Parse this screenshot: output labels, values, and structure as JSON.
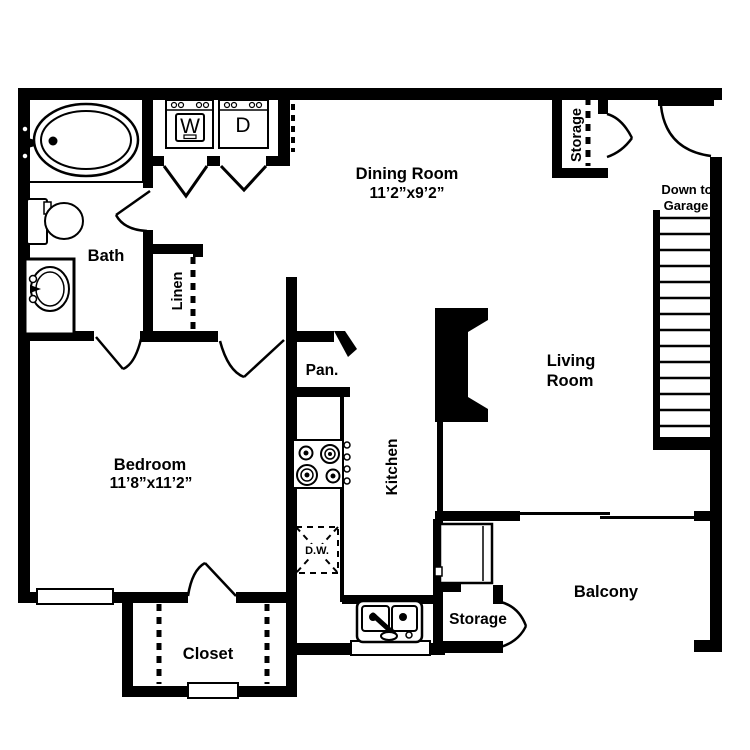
{
  "colors": {
    "wall": "#000000",
    "floor": "#ffffff"
  },
  "rooms": {
    "dining": {
      "name": "Dining Room",
      "dims": "11’2”x9’2”"
    },
    "bedroom": {
      "name": "Bedroom",
      "dims": "11’8”x11’2”"
    },
    "living": {
      "line1": "Living",
      "line2": "Room"
    },
    "bath": {
      "name": "Bath"
    },
    "kitchen": {
      "name": "Kitchen"
    },
    "balcony": {
      "name": "Balcony"
    },
    "closet": {
      "name": "Closet"
    },
    "linen": {
      "name": "Linen"
    },
    "pantry": {
      "name": "Pan."
    },
    "storage_upper": {
      "name": "Storage"
    },
    "storage_lower": {
      "name": "Storage"
    },
    "stairs": {
      "line1": "Down to",
      "line2": "Garage"
    }
  },
  "appliances": {
    "washer": "W",
    "dryer": "D",
    "dishwasher": "D.W."
  }
}
